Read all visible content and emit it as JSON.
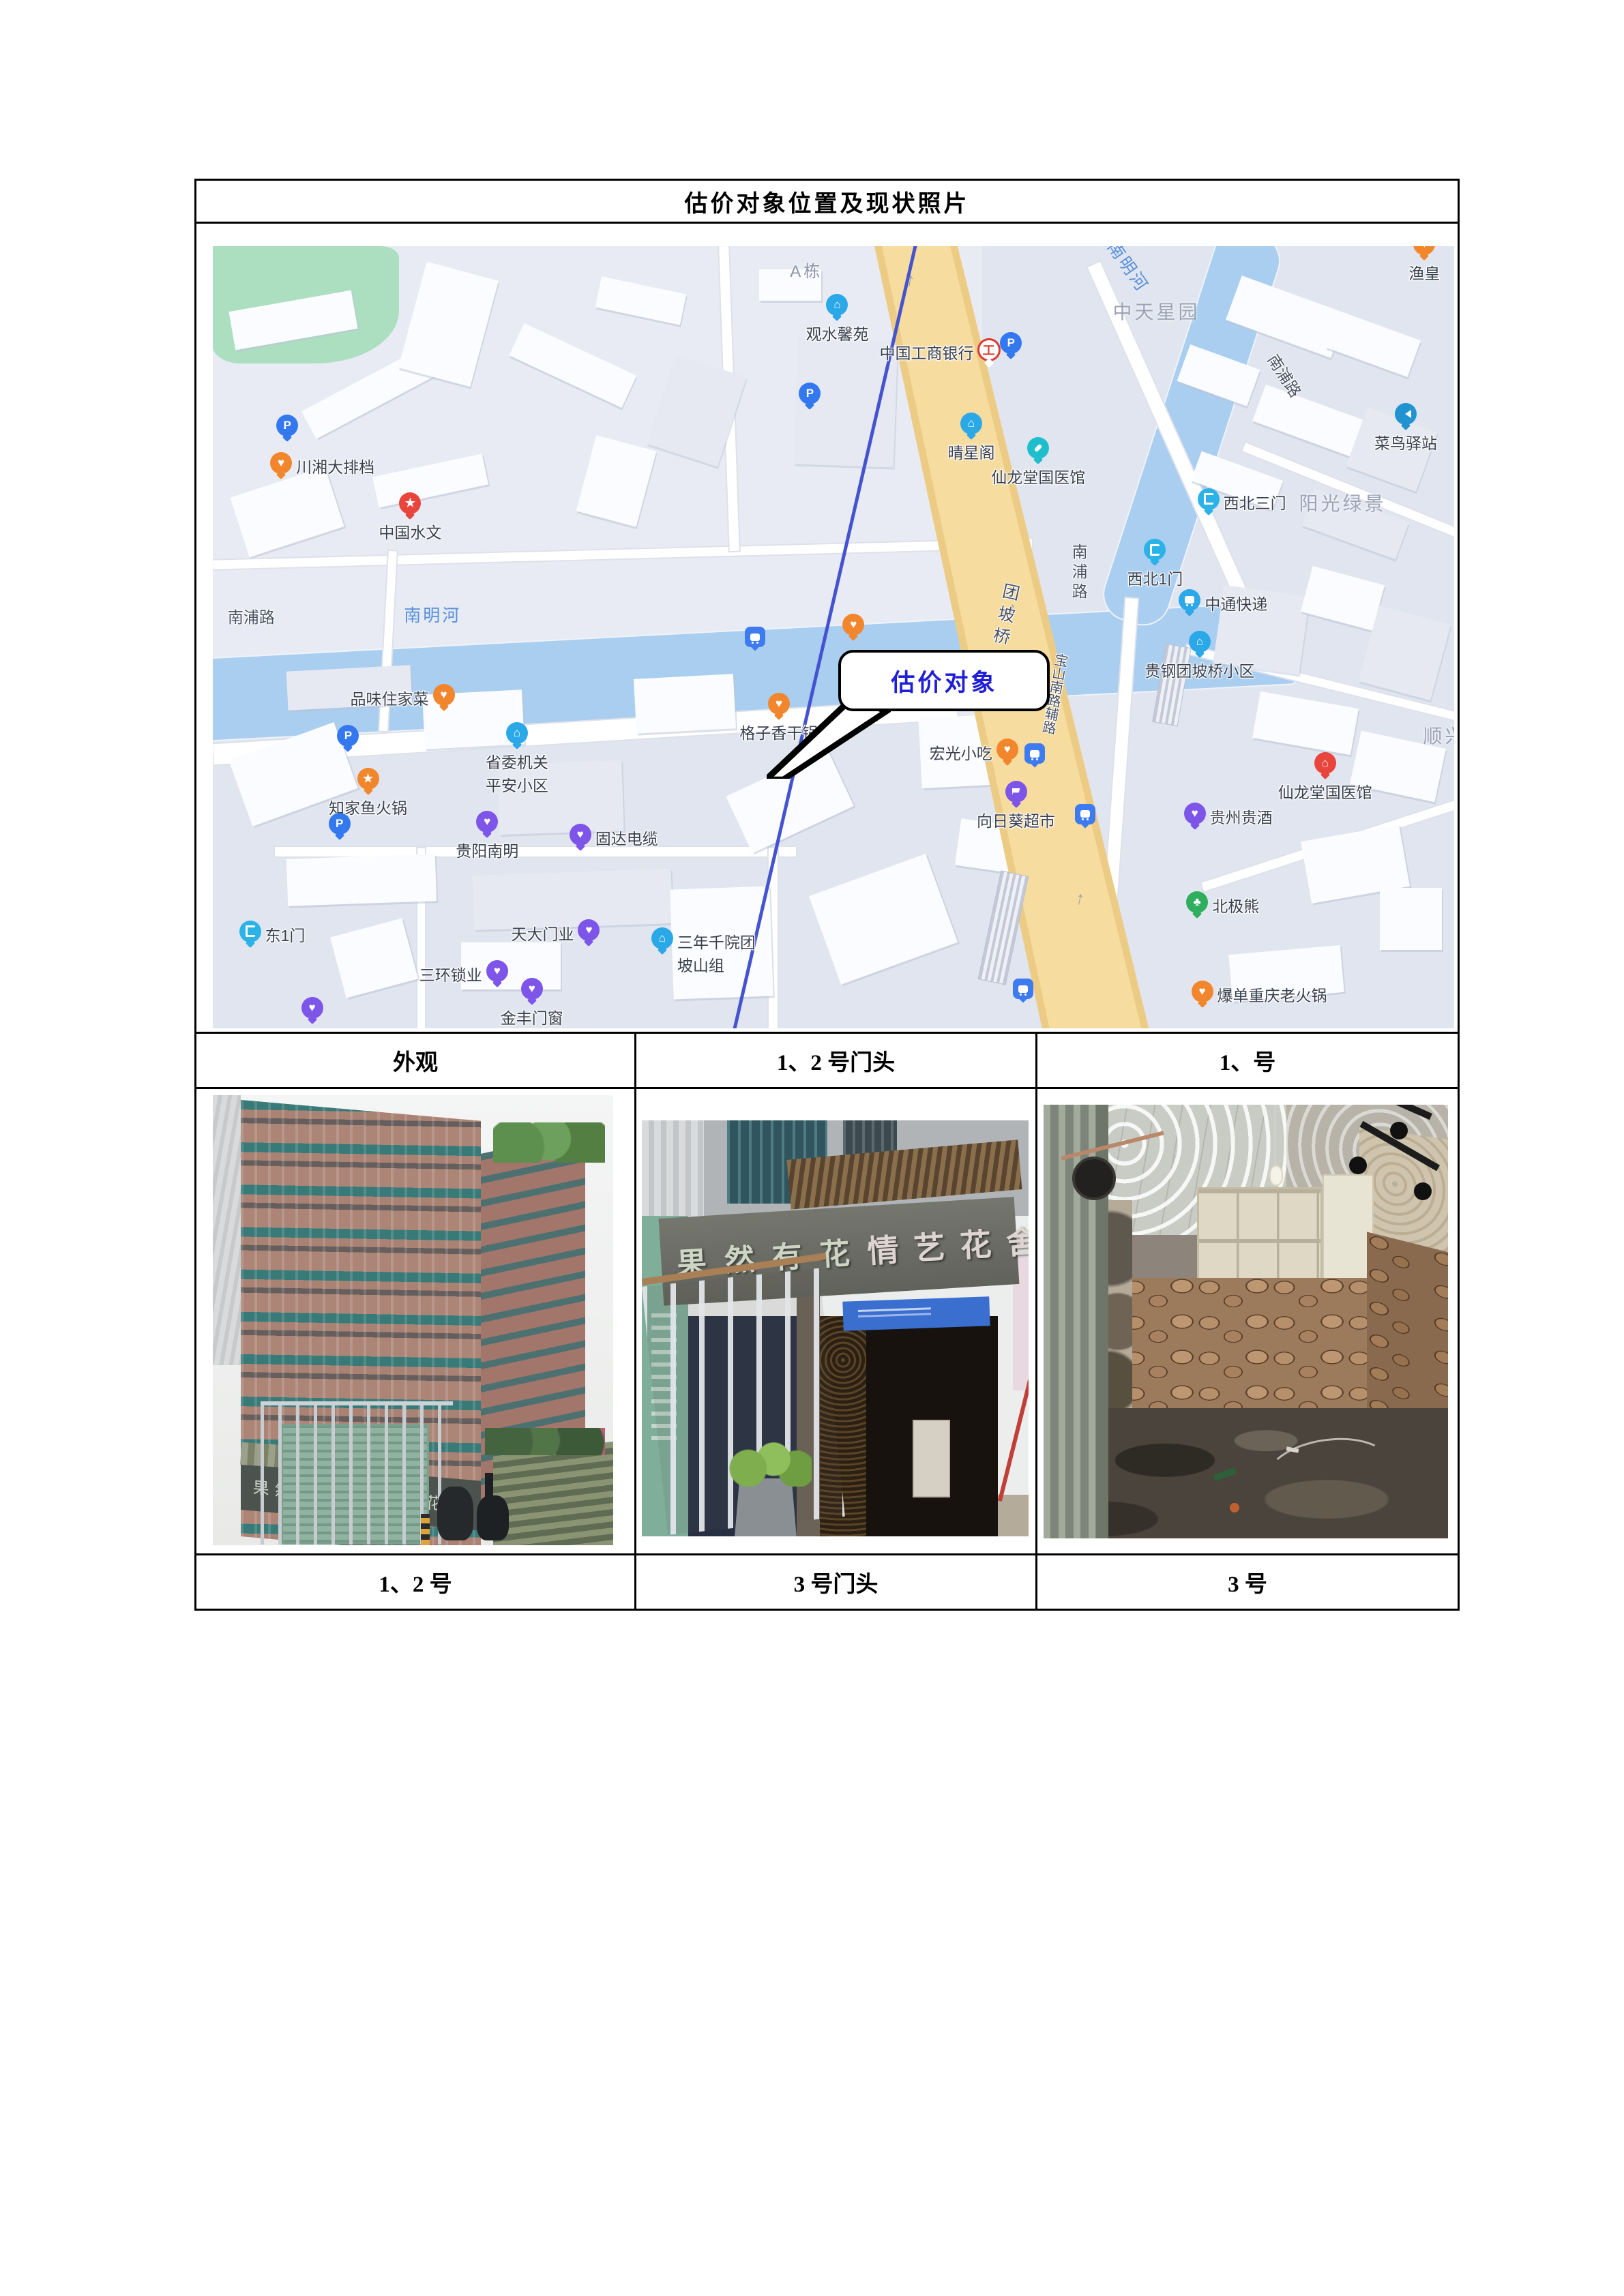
{
  "page": {
    "title": "估价对象位置及现状照片"
  },
  "map": {
    "callout_label": "估价对象",
    "water_labels": {
      "river_h": "南明河",
      "river_diag": "南明河"
    },
    "road_labels": {
      "nanpu_left": "南浦路",
      "nanpu_diag": "南浦路",
      "nanpu_vert": "南浦路",
      "bridge": "团坡桥",
      "baoshan": "宝山南路辅路"
    },
    "area_labels": {
      "zhongtian": "中天星园",
      "yangguang": "阳光绿景",
      "shunxing": "顺兴",
      "adong": "A栋"
    },
    "pois": [
      {
        "label": "川湘大排档"
      },
      {
        "label": "中国水文"
      },
      {
        "label": "观水馨苑"
      },
      {
        "label": "中国工商银行"
      },
      {
        "label": "晴星阁"
      },
      {
        "label": "仙龙堂国医馆"
      },
      {
        "label": "渔皇"
      },
      {
        "label": "菜鸟驿站"
      },
      {
        "label": "西北三门"
      },
      {
        "label": "西北1门"
      },
      {
        "label": "中通快递"
      },
      {
        "label": "贵钢团坡桥小区"
      },
      {
        "label": "仙龙堂国医馆"
      },
      {
        "label": "贵州贵酒"
      },
      {
        "label": "北极熊"
      },
      {
        "label": "爆单重庆老火锅"
      },
      {
        "label": "品味住家菜"
      },
      {
        "label": "知家鱼火锅"
      },
      {
        "label": "省委机关平安小区"
      },
      {
        "label": "格子香干锅"
      },
      {
        "label": "宏光小吃"
      },
      {
        "label": "向日葵超市"
      },
      {
        "label": "三年千院团坡山组"
      },
      {
        "label": "贵阳南明"
      },
      {
        "label": "固达电缆"
      },
      {
        "label": "东1门"
      },
      {
        "label": "天大门业"
      },
      {
        "label": "三环锁业"
      },
      {
        "label": "金丰门窗"
      }
    ]
  },
  "captions": {
    "row1": [
      "外观",
      "1、2 号门头",
      "1、号"
    ],
    "row2": [
      "1、2 号",
      "3 号门头",
      "3 号"
    ]
  },
  "photos": {
    "exterior": {
      "sign_left": "果然有花",
      "sign_right": "情艺花舍"
    },
    "storefront": {
      "sign_left": "果然有花",
      "sign_right": "情艺花舍"
    }
  }
}
